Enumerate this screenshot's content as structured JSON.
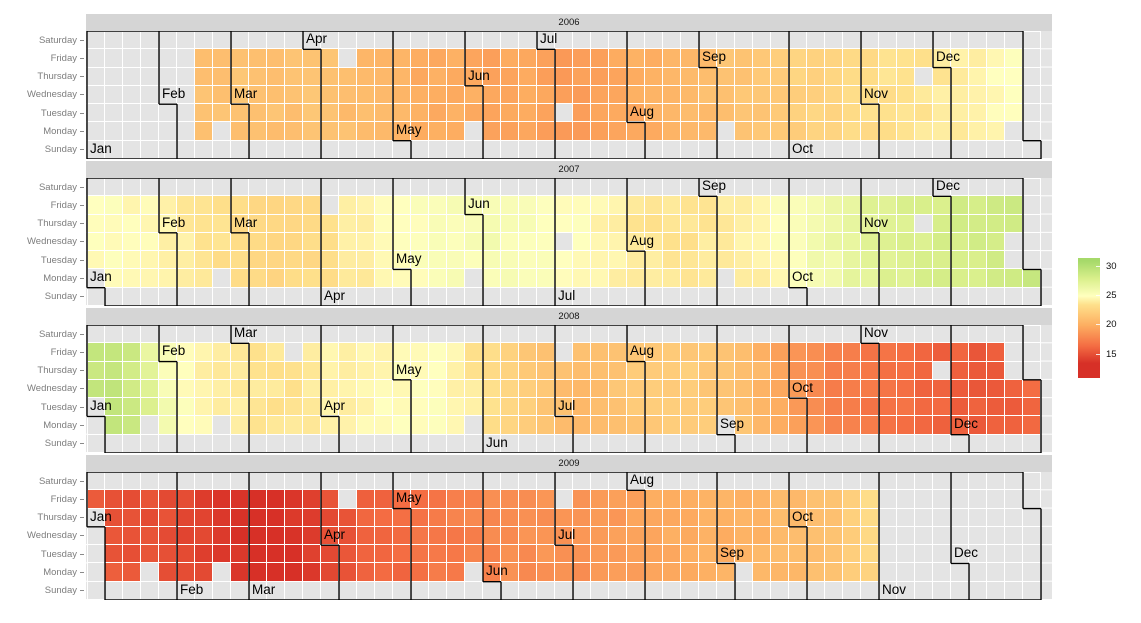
{
  "chart_data": {
    "type": "heatmap",
    "variant": "calendar-heatmap",
    "title": "",
    "facet_titles": [
      "2006",
      "2007",
      "2008",
      "2009"
    ],
    "weekday_rows_top_to_bottom": [
      "Saturday",
      "Friday",
      "Thursday",
      "Wednesday",
      "Tuesday",
      "Monday",
      "Sunday"
    ],
    "month_labels": [
      "Jan",
      "Feb",
      "Mar",
      "Apr",
      "May",
      "Jun",
      "Jul",
      "Aug",
      "Sep",
      "Oct",
      "Nov",
      "Dec"
    ],
    "legend": {
      "tick_labels": [
        "30",
        "25",
        "20",
        "15"
      ],
      "tick_values": [
        30,
        25,
        20,
        15
      ],
      "domain": [
        11,
        31.5
      ],
      "color_stops": [
        [
          13.5,
          "#d73027"
        ],
        [
          16.5,
          "#f46d43"
        ],
        [
          20,
          "#fdae61"
        ],
        [
          23.5,
          "#fee08b"
        ],
        [
          25,
          "#ffffbf"
        ],
        [
          28,
          "#d9ef8b"
        ],
        [
          31,
          "#a6d96a"
        ]
      ]
    },
    "series": {
      "2006": {
        "start": "2006-02-13",
        "end": "2006-12-29",
        "value_anchors_doy": [
          [
            44,
            21.3
          ],
          [
            58,
            21.5
          ],
          [
            74,
            21.3
          ],
          [
            91,
            21.6
          ],
          [
            103,
            21.0
          ],
          [
            121,
            20.5
          ],
          [
            133,
            19.9
          ],
          [
            147,
            20.1
          ],
          [
            160,
            19.5
          ],
          [
            172,
            19.6
          ],
          [
            182,
            19.3
          ],
          [
            192,
            19.1
          ],
          [
            206,
            19.6
          ],
          [
            213,
            19.9
          ],
          [
            227,
            20.4
          ],
          [
            244,
            21.2
          ],
          [
            260,
            21.7
          ],
          [
            274,
            22.3
          ],
          [
            290,
            22.9
          ],
          [
            305,
            23.3
          ],
          [
            319,
            23.6
          ],
          [
            335,
            24.0
          ],
          [
            349,
            24.4
          ],
          [
            363,
            25.1
          ]
        ]
      },
      "2007": {
        "start": "2007-01-02",
        "end": "2007-12-31",
        "value_anchors_doy": [
          [
            2,
            24.9
          ],
          [
            13,
            25.0
          ],
          [
            32,
            24.4
          ],
          [
            46,
            23.7
          ],
          [
            60,
            23.2
          ],
          [
            74,
            22.9
          ],
          [
            88,
            23.3
          ],
          [
            101,
            24.0
          ],
          [
            115,
            24.6
          ],
          [
            129,
            25.2
          ],
          [
            143,
            25.5
          ],
          [
            157,
            25.7
          ],
          [
            172,
            25.4
          ],
          [
            187,
            25.1
          ],
          [
            201,
            24.5
          ],
          [
            215,
            23.9
          ],
          [
            229,
            23.7
          ],
          [
            245,
            23.9
          ],
          [
            259,
            24.3
          ],
          [
            274,
            25.2
          ],
          [
            284,
            26.0
          ],
          [
            296,
            26.8
          ],
          [
            308,
            27.5
          ],
          [
            322,
            27.8
          ],
          [
            336,
            28.1
          ],
          [
            350,
            28.3
          ],
          [
            365,
            28.8
          ]
        ]
      },
      "2008": {
        "start": "2008-01-02",
        "end": "2008-12-31",
        "value_anchors_doy": [
          [
            2,
            29.0
          ],
          [
            8,
            29.4
          ],
          [
            18,
            28.6
          ],
          [
            28,
            26.0
          ],
          [
            38,
            24.7
          ],
          [
            50,
            24.2
          ],
          [
            63,
            23.8
          ],
          [
            77,
            23.7
          ],
          [
            92,
            24.2
          ],
          [
            106,
            24.6
          ],
          [
            120,
            24.8
          ],
          [
            134,
            25.1
          ],
          [
            145,
            24.4
          ],
          [
            153,
            23.5
          ],
          [
            167,
            22.4
          ],
          [
            180,
            21.2
          ],
          [
            190,
            20.9
          ],
          [
            204,
            21.5
          ],
          [
            218,
            22.0
          ],
          [
            232,
            22.1
          ],
          [
            246,
            21.7
          ],
          [
            259,
            20.9
          ],
          [
            272,
            19.3
          ],
          [
            282,
            18.2
          ],
          [
            292,
            17.4
          ],
          [
            306,
            16.9
          ],
          [
            318,
            16.5
          ],
          [
            332,
            16.0
          ],
          [
            346,
            15.7
          ],
          [
            360,
            15.8
          ],
          [
            366,
            16.2
          ]
        ]
      },
      "2009": {
        "start": "2009-01-02",
        "end": "2009-10-30",
        "value_anchors_doy": [
          [
            2,
            15.6
          ],
          [
            14,
            15.3
          ],
          [
            30,
            14.9
          ],
          [
            44,
            14.3
          ],
          [
            58,
            13.6
          ],
          [
            65,
            13.1
          ],
          [
            70,
            13.2
          ],
          [
            82,
            14.2
          ],
          [
            92,
            15.0
          ],
          [
            104,
            15.8
          ],
          [
            118,
            16.4
          ],
          [
            132,
            17.0
          ],
          [
            146,
            17.6
          ],
          [
            160,
            18.2
          ],
          [
            174,
            18.5
          ],
          [
            188,
            18.5
          ],
          [
            202,
            18.9
          ],
          [
            216,
            19.7
          ],
          [
            230,
            20.0
          ],
          [
            244,
            20.2
          ],
          [
            258,
            20.5
          ],
          [
            272,
            20.9
          ],
          [
            286,
            21.4
          ],
          [
            296,
            22.3
          ],
          [
            303,
            23.3
          ]
        ]
      }
    },
    "non_trading_dates": [
      "2006-02-20",
      "2006-04-14",
      "2006-05-29",
      "2006-07-04",
      "2006-09-04",
      "2006-11-23",
      "2006-12-25",
      "2007-01-01",
      "2007-02-19",
      "2007-04-06",
      "2007-05-28",
      "2007-07-04",
      "2007-09-03",
      "2007-11-22",
      "2007-12-25",
      "2007-12-26",
      "2008-01-01",
      "2008-01-21",
      "2008-02-18",
      "2008-03-21",
      "2008-05-26",
      "2008-07-04",
      "2008-09-01",
      "2008-11-27",
      "2008-12-25",
      "2008-12-26",
      "2009-01-01",
      "2009-01-19",
      "2009-02-16",
      "2009-04-10",
      "2009-05-25",
      "2009-07-03",
      "2009-09-07"
    ],
    "value_jitter": 0.7,
    "colors": {
      "na_cell": "#e4e4e4",
      "panel_bg": "#e4e4e4",
      "strip_bg": "#d5d5d5",
      "gridline": "#ffffff",
      "month_outline": "#000000",
      "axis_text": "#7d7d7d",
      "strip_text": "#141414",
      "month_label_text": "#000000"
    }
  }
}
